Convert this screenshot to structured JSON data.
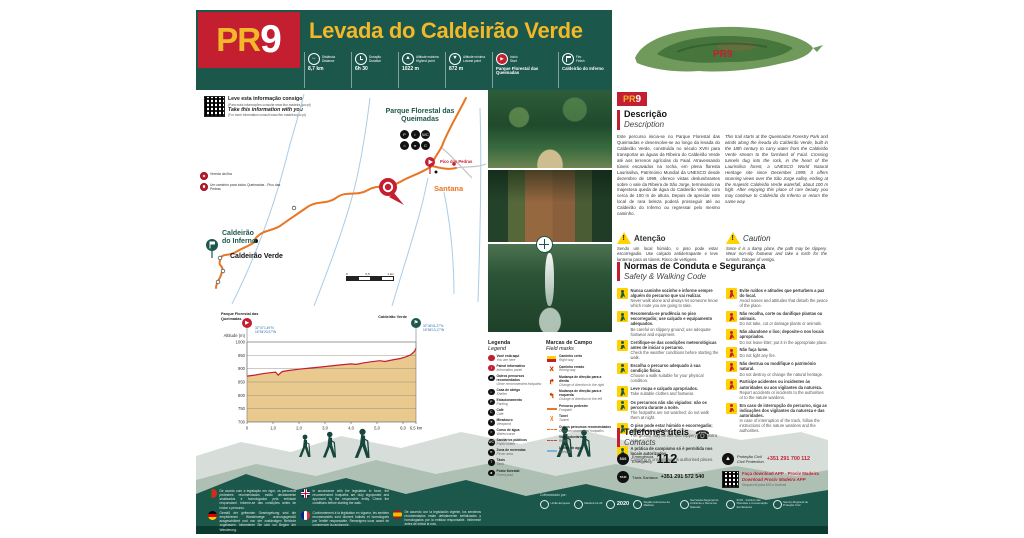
{
  "header": {
    "pr_prefix": "PR",
    "pr_number": "9",
    "title": "Levada do Caldeirão Verde"
  },
  "stats": [
    {
      "icon": "distance-icon",
      "glyph": "↔",
      "label_pt": "Distância",
      "label_en": "Distance",
      "value": "8,7 km",
      "width": "narrow"
    },
    {
      "icon": "duration-icon",
      "glyph": "",
      "label_pt": "Duração",
      "label_en": "Duration",
      "value": "6h 30",
      "width": "narrow"
    },
    {
      "icon": "max-altitude-icon",
      "glyph": "▲",
      "label_pt": "Altitude máxima",
      "label_en": "Highest point",
      "value": "1022 m",
      "width": "narrow"
    },
    {
      "icon": "min-altitude-icon",
      "glyph": "▼",
      "label_pt": "Altitude mínima",
      "label_en": "Lowest point",
      "value": "872 m",
      "width": "narrow"
    },
    {
      "icon": "start-icon",
      "glyph": "▶",
      "label_pt": "Início",
      "label_en": "Start",
      "value": "Parque Florestal das Queimadas",
      "width": "wide"
    },
    {
      "icon": "finish-icon",
      "glyph": "",
      "label_pt": "Fim",
      "label_en": "Finish",
      "value": "Caldeirão do Inferno",
      "width": "wide"
    }
  ],
  "qr_info": {
    "pt": "Leve esta informação consigo",
    "pt_sub": "(Para mais informações consulte www.ifcn.madeira.gov.pt)",
    "en": "Take this information with you",
    "en_sub": "(For more information consult www.ifcn.madeira.gov.pt)"
  },
  "map": {
    "labels": {
      "queimadas": "Parque Florestal das Queimadas",
      "pico_pedras": "Pico das Pedras",
      "santana": "Santana",
      "caldeirao_verde": "Caldeirão Verde",
      "caldeirao_inferno_1": "Caldeirão",
      "caldeirao_inferno_2": "do Inferno"
    },
    "mini_legend": [
      {
        "icon": "red-circle-icon",
        "label": "Vereda da Ilha"
      },
      {
        "icon": "red-pin-icon",
        "label": "Um caminho para todos Queimadas - Pico das Pedras"
      }
    ],
    "facilities": [
      {
        "icon": "parking-icon",
        "glyph": "P"
      },
      {
        "icon": "info-icon",
        "glyph": "i"
      },
      {
        "icon": "toilets-icon",
        "glyph": "WC"
      },
      {
        "icon": "shelter-icon",
        "glyph": "⌂"
      },
      {
        "icon": "picnic-icon",
        "glyph": "π"
      },
      {
        "icon": "cafe-icon",
        "glyph": "C"
      }
    ],
    "scale": {
      "start": "0",
      "mid": "0,5",
      "end": "1 km"
    }
  },
  "island": {
    "marker": "PR9"
  },
  "profile": {
    "start": {
      "name": "Parque Florestal das Queimadas",
      "lat": "32°47'1,49''N",
      "lon": "16°54'20,07''W"
    },
    "end": {
      "name": "Caldeirão Verde",
      "lat": "32°46'41,27''N",
      "lon": "16°56'13,17''W"
    },
    "ylabel": "Altitude (m)",
    "chart_data": {
      "type": "area",
      "title": "Perfil de altitude PR9 Levada do Caldeirão Verde",
      "xlabel": "km",
      "ylabel": "Altitude (m)",
      "x_km": [
        0,
        0.3,
        0.6,
        0.9,
        1.1,
        1.2,
        1.35,
        1.6,
        2.0,
        2.4,
        2.8,
        3.2,
        3.6,
        4.0,
        4.2,
        4.5,
        4.8,
        5.1,
        5.3,
        5.6,
        5.9,
        6.1,
        6.3,
        6.45,
        6.5
      ],
      "altitude_m": [
        872,
        876,
        881,
        885,
        887,
        876,
        889,
        893,
        898,
        902,
        906,
        910,
        914,
        918,
        916,
        922,
        926,
        930,
        927,
        933,
        938,
        944,
        952,
        966,
        977
      ],
      "xticks": [
        "0",
        "1,0",
        "2,0",
        "3,0",
        "4,0",
        "5,0",
        "6,0",
        "6,5 km"
      ],
      "xtick_values": [
        0,
        1,
        2,
        3,
        4,
        5,
        6,
        6.5
      ],
      "yticks": [
        1000,
        950,
        900,
        850,
        800,
        750,
        700
      ],
      "ylim": [
        700,
        1000
      ],
      "xlim": [
        0,
        6.5
      ],
      "line_color": "#C41E31",
      "fill_color": "#E9C98E"
    }
  },
  "legend": {
    "title_pt": "Legenda",
    "title_en": "Legend",
    "items": [
      {
        "icon": "you-are-here-icon",
        "glyph": "",
        "pt": "Você está aqui",
        "en": "You are here"
      },
      {
        "icon": "info-panel-icon",
        "glyph": "i",
        "pt": "Painel informativo",
        "en": "Information panel"
      },
      {
        "icon": "other-footpaths-icon",
        "glyph": "⇄",
        "pt": "Outros percursos recomendados",
        "en": "Other recommended footpaths"
      },
      {
        "icon": "shelter-icon",
        "glyph": "⌂",
        "pt": "Casa de abrigo",
        "en": "Shelter"
      },
      {
        "icon": "parking-icon",
        "glyph": "P",
        "pt": "Estacionamento",
        "en": "Parking"
      },
      {
        "icon": "cafe-icon",
        "glyph": "C",
        "pt": "Café",
        "en": "Café"
      },
      {
        "icon": "viewpoint-icon",
        "glyph": "☀",
        "pt": "Miradouro",
        "en": "Viewpoint"
      },
      {
        "icon": "watercourse-icon",
        "glyph": "≈",
        "pt": "Curso de água",
        "en": "Watercourse"
      },
      {
        "icon": "toilets-icon",
        "glyph": "WC",
        "pt": "Sanitários públicos",
        "en": "Public toilets"
      },
      {
        "icon": "picnic-icon",
        "glyph": "π",
        "pt": "Zona de merendas",
        "en": "Picnic area"
      },
      {
        "icon": "taxi-icon",
        "glyph": "T",
        "pt": "Táxis",
        "en": "Taxis"
      },
      {
        "icon": "forest-post-icon",
        "glyph": "♣",
        "pt": "Posto florestal",
        "en": "Forest post"
      }
    ]
  },
  "field_marks": {
    "title_pt": "Marcas de Campo",
    "title_en": "Field marks",
    "items": [
      {
        "icon": "right-way-mark",
        "glyph": "",
        "pt": "Caminho certo",
        "en": "Right way"
      },
      {
        "icon": "wrong-way-mark",
        "glyph": "X",
        "pt": "Caminho errado",
        "en": "Wrong way"
      },
      {
        "icon": "turn-right-mark",
        "glyph": "↱",
        "pt": "Mudança de direção para a direita",
        "en": "Change of direction to the right"
      },
      {
        "icon": "turn-left-mark",
        "glyph": "↰",
        "pt": "Mudança de direção para a esquerda",
        "en": "Change of direction to the left"
      },
      {
        "icon": "footpath-line",
        "glyph": "",
        "pt": "Percurso pedestre",
        "en": "Footpath"
      },
      {
        "icon": "tunnel-mark",
        "glyph": ")(",
        "pt": "Túnel",
        "en": "Tunnel"
      },
      {
        "icon": "other-footpaths-line",
        "glyph": "",
        "pt": "Outros percursos recomendados",
        "en": "Other recommended footpaths"
      },
      {
        "icon": "roads-line",
        "glyph": "",
        "pt": "Vias rodoviárias",
        "en": "Roads"
      },
      {
        "icon": "streams-line",
        "glyph": "",
        "pt": "Linhas de água",
        "en": "Streams"
      }
    ]
  },
  "description": {
    "title_pt": "Descrição",
    "title_en": "Description",
    "text_pt": "Este percurso inicia-se no Parque Florestal das Queimadas e desenvolve-se ao longo da levada do Caldeirão Verde, construída no século XVIII para transportar as águas da Ribeira do Caldeirão Verde até aos terrenos agrícolas do Faial. Atravessando túneis escavados na rocha, em plena floresta Laurissilva, Património Mundial da UNESCO desde dezembro de 1999, oferece vistas deslumbrantes sobre o vale da Ribeira de São Jorge, terminando na majestosa queda de água do Caldeirão Verde, com cerca de 100 m de altura. Depois de apreciar este local de rara beleza poderá prosseguir até ao Caldeirão do Inferno ou regressar pelo mesmo caminho.",
    "text_en": "This trail starts at the Queimadas Forestry Park and winds along the levada do Caldeirão Verde, built in the 18th century to carry water from the Caldeirão Verde stream to the farmland of Faial. Crossing tunnels dug into the rock, in the heart of the Laurissilva forest, a UNESCO World Natural Heritage site since December 1999, it offers stunning views over the São Jorge valley, ending at the majestic Caldeirão Verde waterfall, about 100 m high. After enjoying this place of rare beauty you may continue to Caldeirão do Inferno or return the same way."
  },
  "caution": {
    "title_pt": "Atenção",
    "title_en": "Caution",
    "text_pt": "Sendo um local húmido, o piso pode estar escorregadio. Use calçado antiderrapante e leve lanterna para os túneis. Risco de vertigens.",
    "text_en": "Since it is a damp place, the path may be slippery. Wear non-slip footwear and take a torch for the tunnels. Danger of vertigo."
  },
  "safety": {
    "title_pt": "Normas de Conduta e Segurança",
    "title_en": "Safety & Walking Code",
    "left": [
      {
        "icon": "hikers-icon",
        "color": "green",
        "pt": "Nunca caminhe sozinho e informe sempre alguém do percurso que vai realizar.",
        "en": "Never walk alone and always let someone know which route you are going to take."
      },
      {
        "icon": "slippery-icon",
        "color": "green",
        "pt": "Recomenda-se prudência no piso escorregadio; use calçado e equipamento adequados.",
        "en": "Be careful on slippery ground; use adequate footwear and equipment."
      },
      {
        "icon": "weather-icon",
        "color": "green",
        "pt": "Certifique-se das condições meteorológicas antes de iniciar o percurso.",
        "en": "Check the weather conditions before starting the walk."
      },
      {
        "icon": "fitness-icon",
        "color": "green",
        "pt": "Escolha o percurso adequado à sua condição física.",
        "en": "Choose a walk suitable for your physical condition."
      },
      {
        "icon": "clothing-icon",
        "color": "green",
        "pt": "Leve roupa e calçado apropriados.",
        "en": "Take suitable clothes and footwear."
      },
      {
        "icon": "night-icon",
        "color": "green",
        "pt": "Os percursos não são vigiados: não os percorra durante a noite.",
        "en": "The footpaths are not watched: do not walk them at night."
      },
      {
        "icon": "wet-ground-icon",
        "color": "green",
        "pt": "O piso pode estar húmido e escorregadio; redobre os cuidados.",
        "en": "The ground may be wet and slippery; take extra care."
      },
      {
        "icon": "camping-icon",
        "color": "green",
        "pt": "A prática de campismo só é permitida nos locais autorizados.",
        "en": "Camping is only allowed in authorised places."
      }
    ],
    "right": [
      {
        "icon": "noise-icon",
        "color": "red",
        "pt": "Evite ruídos e atitudes que perturbem a paz do local.",
        "en": "Avoid noises and attitudes that disturb the peace of the place."
      },
      {
        "icon": "no-picking-icon",
        "color": "red",
        "pt": "Não recolha, corte ou danifique plantas ou animais.",
        "en": "Do not take, cut or damage plants or animals."
      },
      {
        "icon": "no-litter-icon",
        "color": "red",
        "pt": "Não abandone o lixo; deposite-o nos locais apropriados.",
        "en": "Do not leave litter; put it in the appropriate place."
      },
      {
        "icon": "no-fire-icon",
        "color": "red",
        "pt": "Não faça lume.",
        "en": "Do not light any fire."
      },
      {
        "icon": "no-damage-icon",
        "color": "red",
        "pt": "Não destrua ou modifique o património natural.",
        "en": "Do not destroy or change the natural heritage."
      },
      {
        "icon": "report-icon",
        "color": "red",
        "pt": "Participe acidentes ou incidentes às autoridades ou aos vigilantes da natureza.",
        "en": "Report accidents or incidents to the authorities or to the nature wardens."
      },
      {
        "icon": "interruption-icon",
        "color": "red",
        "pt": "Em caso de interrupção do percurso, siga as indicações dos vigilantes da natureza e das autoridades.",
        "en": "In case of interruption of the track, follow the instructions of the nature wardens and the authorities."
      }
    ]
  },
  "contacts": {
    "title_pt": "Telefones úteis",
    "title_en": "Contacts",
    "emergency": {
      "label_pt": "Emergência",
      "label_en": "Emergency",
      "number": "112"
    },
    "taxi": {
      "label": "Táxis Santana",
      "number": "+351 291 572 540"
    },
    "civil_protection": {
      "label_pt": "Proteção Civil",
      "label_en": "Civil Protection",
      "number": "+351 291 700 112"
    },
    "app": {
      "line1": "Faça download APP - Prociv Madeira",
      "line2": "Download Prociv Madeira APP",
      "note": "Disponível para iOS e Android"
    }
  },
  "footer": {
    "notes": [
      {
        "flag": "pt",
        "text": "De acordo com a legislação em vigor, os percursos pedestres recomendados estão devidamente sinalizados e homologados pela entidade responsável. Informe-se das condições antes de iniciar o percurso."
      },
      {
        "flag": "gb",
        "text": "In accordance with the legislation in force, the recommended footpaths are duly signposted and approved by the responsible entity. Check the conditions before starting the walk."
      },
      {
        "flag": "de",
        "text": "Gemäß der geltenden Gesetzgebung sind die empfohlenen Wanderwege ordnungsgemäß ausgeschildert und von der zuständigen Behörde zugelassen. Informieren Sie sich vor Beginn der Wanderung."
      },
      {
        "flag": "fr",
        "text": "Conformément à la législation en vigueur, les sentiers recommandés sont dûment balisés et homologués par l'entité responsable. Renseignez-vous avant de commencer la randonnée."
      },
      {
        "flag": "es",
        "text": "De acuerdo con la legislación vigente, los senderos recomendados están debidamente señalizados y homologados por la entidad responsable. Infórmese antes de iniciar la ruta."
      }
    ],
    "cofinanced_label": "Cofinanciado por:",
    "logos": [
      {
        "name": "eu-logo",
        "label": "União Europeia",
        "style": ""
      },
      {
        "name": "madeira1420-logo",
        "label": "Madeira 14-20",
        "style": ""
      },
      {
        "name": "madeira2020-logo",
        "label": "2020",
        "style": "big"
      },
      {
        "name": "ram-logo",
        "label": "Região Autónoma da Madeira",
        "style": ""
      },
      {
        "name": "sra-logo",
        "label": "Secretaria Regional de Ambiente e Recursos Naturais",
        "style": ""
      },
      {
        "name": "ifcn-logo",
        "label": "IFCN · Instituto das Florestas e Conservação da Natureza",
        "style": ""
      },
      {
        "name": "prociv-logo",
        "label": "Serviço Regional de Proteção Civil",
        "style": ""
      }
    ]
  }
}
